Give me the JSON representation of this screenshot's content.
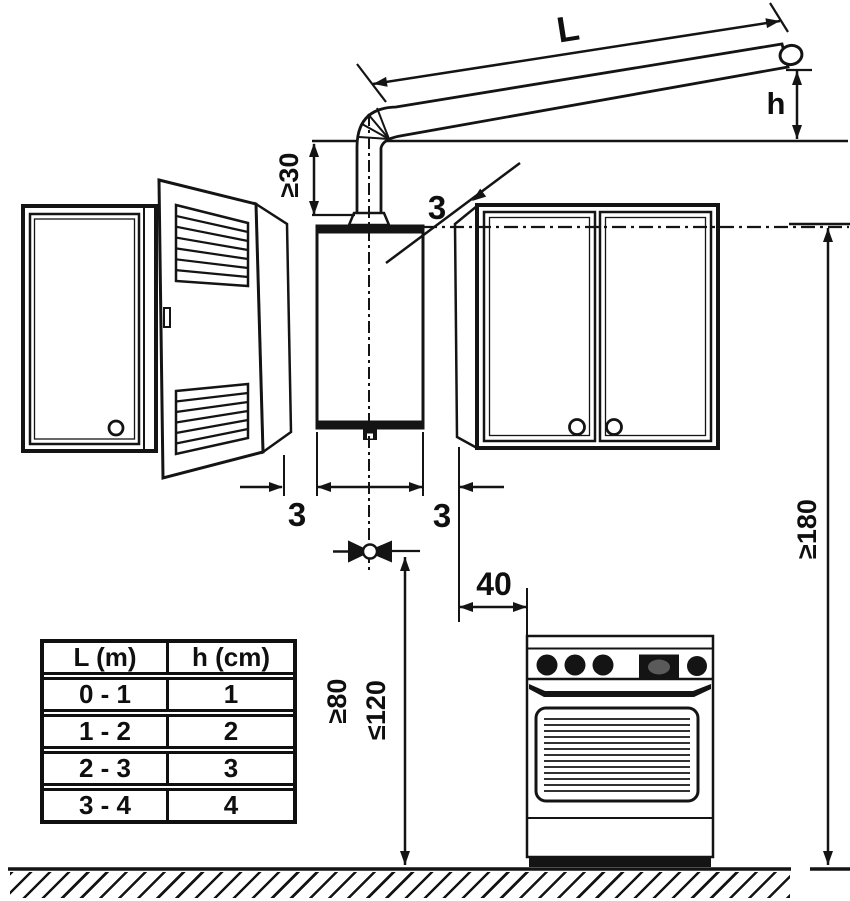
{
  "labels": {
    "flue_length": "L",
    "flue_end_height": "h",
    "flue_vertical_min": "≥30",
    "gap_top": "3",
    "gap_left": "3",
    "gap_right": "3",
    "stove_clearance": "40",
    "valve_height_min": "≥80",
    "valve_height_max": "≤120",
    "heater_top_height": "≥180"
  },
  "table": {
    "headers": [
      "L (m)",
      "h (cm)"
    ],
    "rows": [
      [
        "0 - 1",
        "1"
      ],
      [
        "1 - 2",
        "2"
      ],
      [
        "2 - 3",
        "3"
      ],
      [
        "3 - 4",
        "4"
      ]
    ]
  },
  "colors": {
    "line": "#141414",
    "background": "#ffffff"
  }
}
